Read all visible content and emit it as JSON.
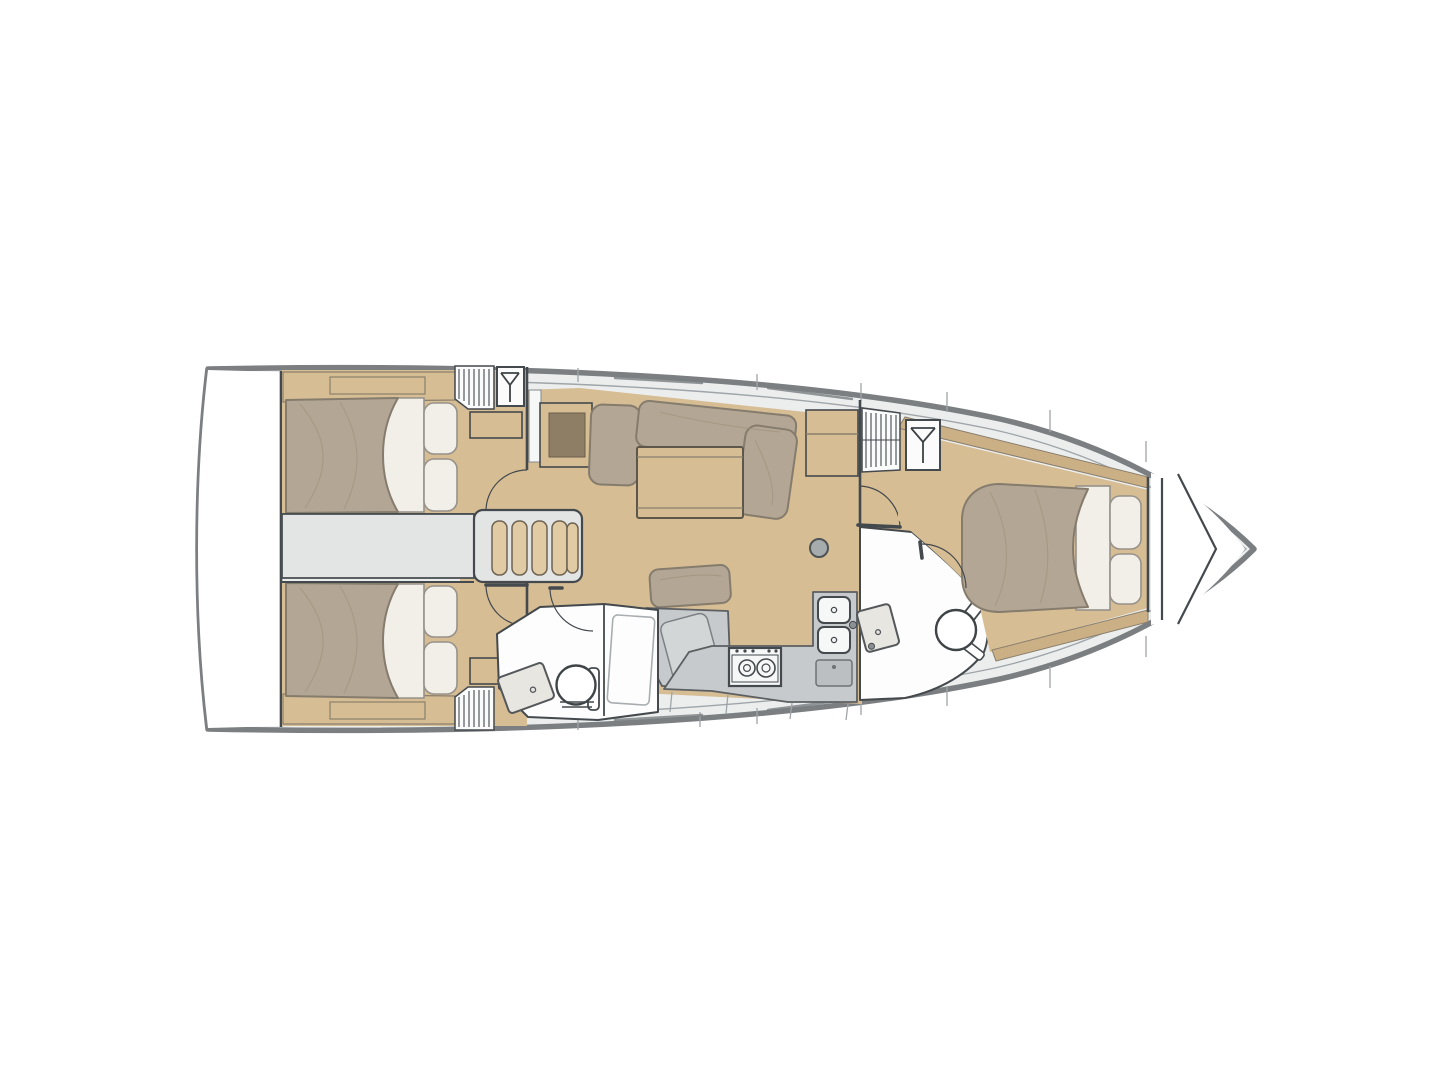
{
  "diagram": {
    "kind": "sailboat-interior-floor-plan",
    "orientation": "bow-right",
    "areas": [
      "transom",
      "aft-cabin-port",
      "aft-cabin-starboard",
      "engine-room-companionway",
      "saloon",
      "galley",
      "nav-station",
      "head-port-aft",
      "head-starboard-forward",
      "forward-cabin",
      "anchor-locker"
    ],
    "icons": {
      "wardrobe": "hanger-icon",
      "ventilation": "grate-lines-icon",
      "stove": "two-burner-stove-icon",
      "sink": "basin-with-drain-icon",
      "toilet": "marine-toilet-icon",
      "mast": "mast-post-circle",
      "door": "quarter-arc-swing",
      "companionway": "ladder-steps-icon"
    },
    "palette": {
      "page_bg": "#ffffff",
      "hull_outline": "#7b7f82",
      "deck_fill": "#eceeee",
      "deck_line": "#9fa5a8",
      "wall_line": "#44494d",
      "wood": "#d6bd94",
      "wood_light": "#e0cba4",
      "wood_grain": "#b89d72",
      "wood_dark": "#8f7e66",
      "cushion": "#b3a694",
      "cushion_edge": "#857c6e",
      "linen": "#f2efe8",
      "linen_edge": "#97928a",
      "gray_furniture": "#c7cacc",
      "gray_furniture_dark": "#9fa3a6",
      "room_white": "#fdfdfd",
      "corridor_gray": "#e3e4e4",
      "appliance_white": "#f6f7f7",
      "steel": "#8b9093"
    }
  }
}
